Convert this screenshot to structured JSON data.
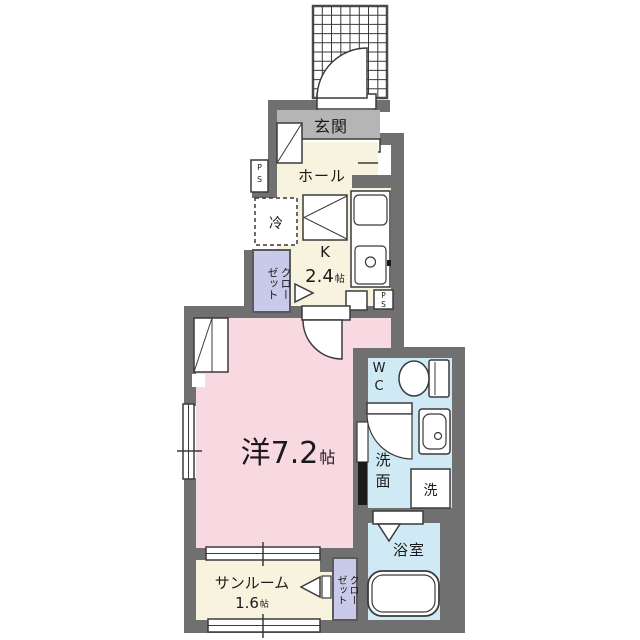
{
  "colors": {
    "wall": "#707070",
    "genkan_floor": "#b5b5b5",
    "kitchen_hall_floor": "#f8f3de",
    "main_room_floor": "#f8d9e1",
    "wet_area_floor": "#cfe9f5",
    "closet_floor": "#c9c9e9",
    "line": "#3a3a3a",
    "text": "#1a1a1a"
  },
  "rooms": {
    "genkan": {
      "label": "玄関"
    },
    "hall": {
      "label": "ホール"
    },
    "kitchen": {
      "label": "K",
      "size": "2.4",
      "size_unit": "帖",
      "fridge_label": "冷"
    },
    "closet_upper": {
      "label": "クロー\nゼット"
    },
    "main_room": {
      "label": "洋7.2",
      "size_unit": "帖"
    },
    "wc": {
      "label": "W\nC"
    },
    "washroom": {
      "label": "洗\n面",
      "washer_label": "洗"
    },
    "bath": {
      "label": "浴室"
    },
    "sunroom": {
      "label": "サンルーム",
      "size": "1.6",
      "size_unit": "帖"
    },
    "closet_lower": {
      "label": "クロー\nゼット"
    },
    "pipe_space_upper": {
      "label": "P\nS"
    },
    "pipe_space_lower": {
      "label": "P\nS"
    }
  }
}
